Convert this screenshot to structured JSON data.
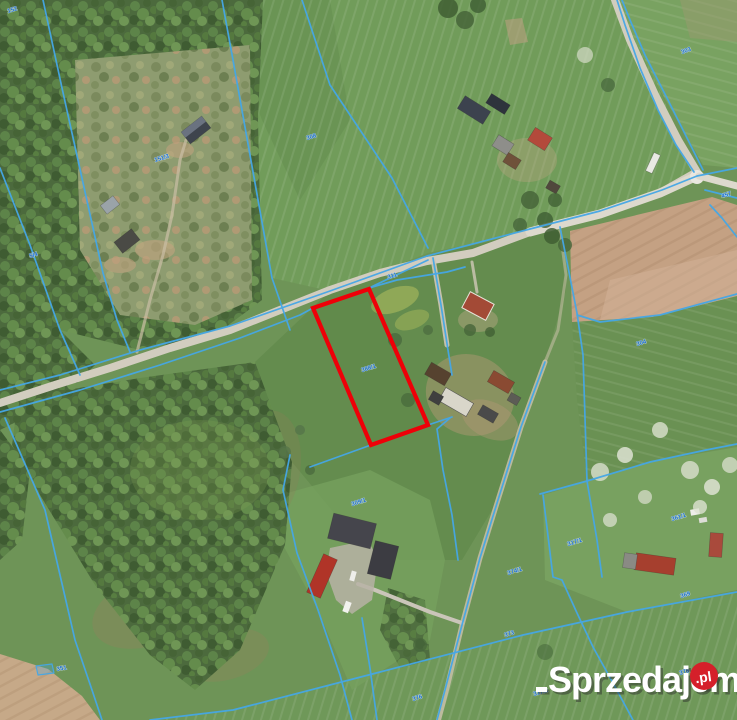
{
  "meta": {
    "type": "aerial-cadastral-parcel-map"
  },
  "watermark": {
    "brand": "Sprzedajemy",
    "tld": ".pl",
    "brand_color": "#ffffff",
    "badge_color": "#d5202a"
  },
  "map": {
    "highlight_color": "#ee0008",
    "boundary_color": "#45a7e6",
    "label_color": "#1d6fd1",
    "highlighted_parcel": {
      "label": "388/1"
    },
    "parcel_labels": [
      {
        "text": "152"
      },
      {
        "text": "151/3"
      },
      {
        "text": "5/4"
      },
      {
        "text": "308"
      },
      {
        "text": "303"
      },
      {
        "text": "311"
      },
      {
        "text": "388/1"
      },
      {
        "text": "309/1"
      },
      {
        "text": "374/1"
      },
      {
        "text": "317/1"
      },
      {
        "text": "361/1"
      },
      {
        "text": "369"
      },
      {
        "text": "304"
      },
      {
        "text": "373"
      },
      {
        "text": "376"
      },
      {
        "text": "317/2"
      },
      {
        "text": "378"
      },
      {
        "text": "457"
      },
      {
        "text": "351"
      }
    ]
  }
}
